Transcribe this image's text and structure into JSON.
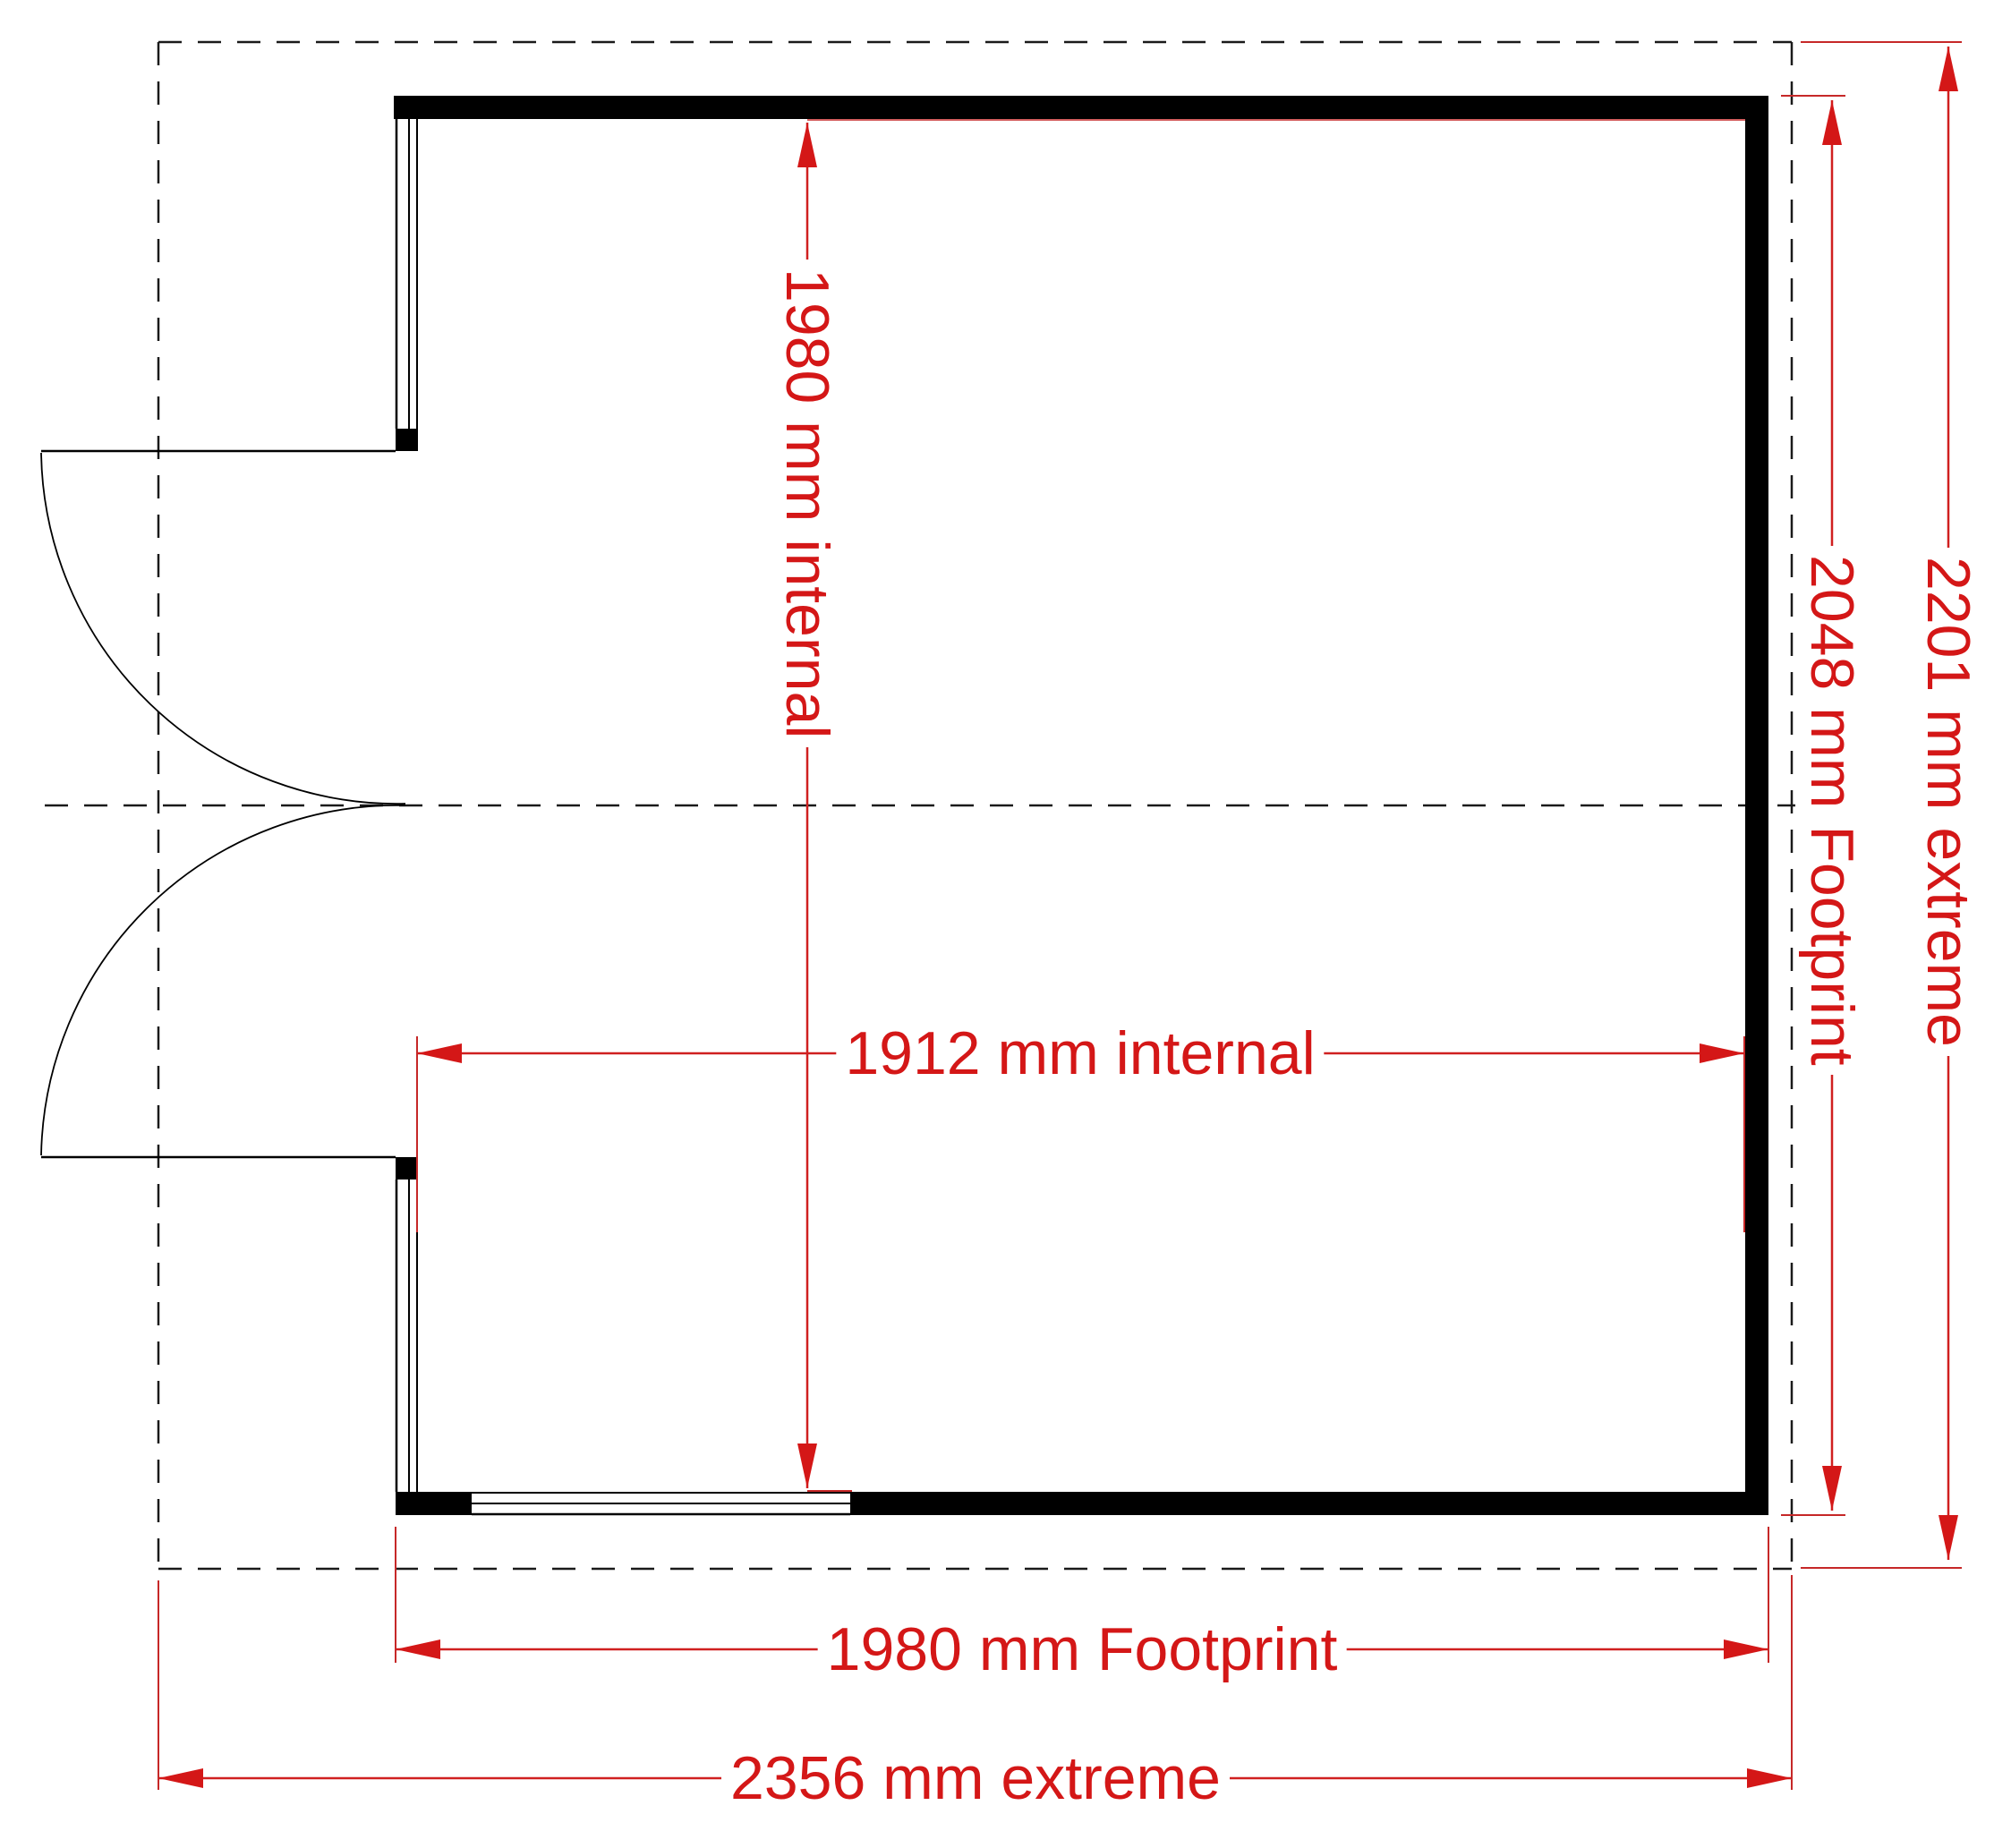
{
  "floor_plan": {
    "type": "shed-garden-building-plan",
    "dimension_labels": {
      "internal_depth": "1980 mm internal",
      "internal_width": "1912 mm internal",
      "footprint_depth": "2048 mm Footprint",
      "footprint_width": "1980 mm Footprint",
      "extreme_depth": "2201 mm extreme",
      "extreme_width": "2356 mm extreme"
    },
    "colors": {
      "dimension_red": "#d41717",
      "wall_black": "#000000",
      "background": "#ffffff"
    }
  }
}
